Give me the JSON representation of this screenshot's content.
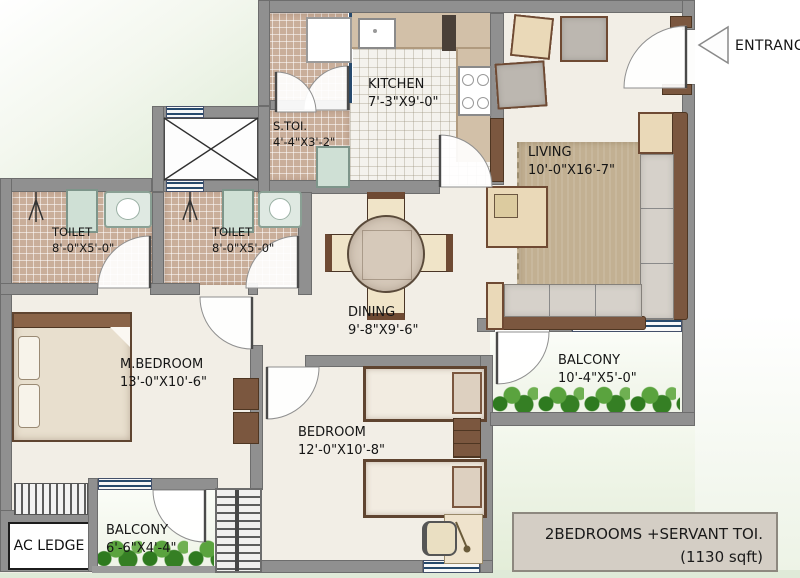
{
  "plan_title": "2 BHK Floor Plan",
  "rooms": {
    "kitchen": {
      "name": "KITCHEN",
      "dims": "7'-3\"X9'-0\""
    },
    "servant_toilet": {
      "name": "S.TOI.",
      "dims": "4'-4\"X3'-2\""
    },
    "living": {
      "name": "LIVING",
      "dims": "10'-0\"X16'-7\""
    },
    "toilet_1": {
      "name": "TOILET",
      "dims": "8'-0\"X5'-0\""
    },
    "toilet_2": {
      "name": "TOILET",
      "dims": "8'-0\"X5'-0\""
    },
    "dining": {
      "name": "DINING",
      "dims": "9'-8\"X9'-6\""
    },
    "master_bedroom": {
      "name": "M.BEDROOM",
      "dims": "13'-0\"X10'-6\""
    },
    "bedroom": {
      "name": "BEDROOM",
      "dims": "12'-0\"X10'-8\""
    },
    "balcony_living": {
      "name": "BALCONY",
      "dims": "10'-4\"X5'-0\""
    },
    "balcony_bedroom": {
      "name": "BALCONY",
      "dims": "6'-6\"X4'-4\""
    },
    "ac_ledge": {
      "name": "AC LEDGE"
    }
  },
  "entrance": {
    "label": "ENTRANCE"
  },
  "title_box": {
    "line1": "2BEDROOMS +SERVANT TOI.",
    "line2": "(1130 sqft)"
  },
  "colors": {
    "wall_gray": "#909090",
    "tile_brown": "#c9ae9a",
    "kitchen_tile": "#f4f2ed",
    "wood_brown": "#7b573f",
    "rug_tan": "#c2b092",
    "plant_green": "#2e7a1f",
    "window_blue": "#274a6d",
    "title_box_bg": "#d4cec5"
  }
}
